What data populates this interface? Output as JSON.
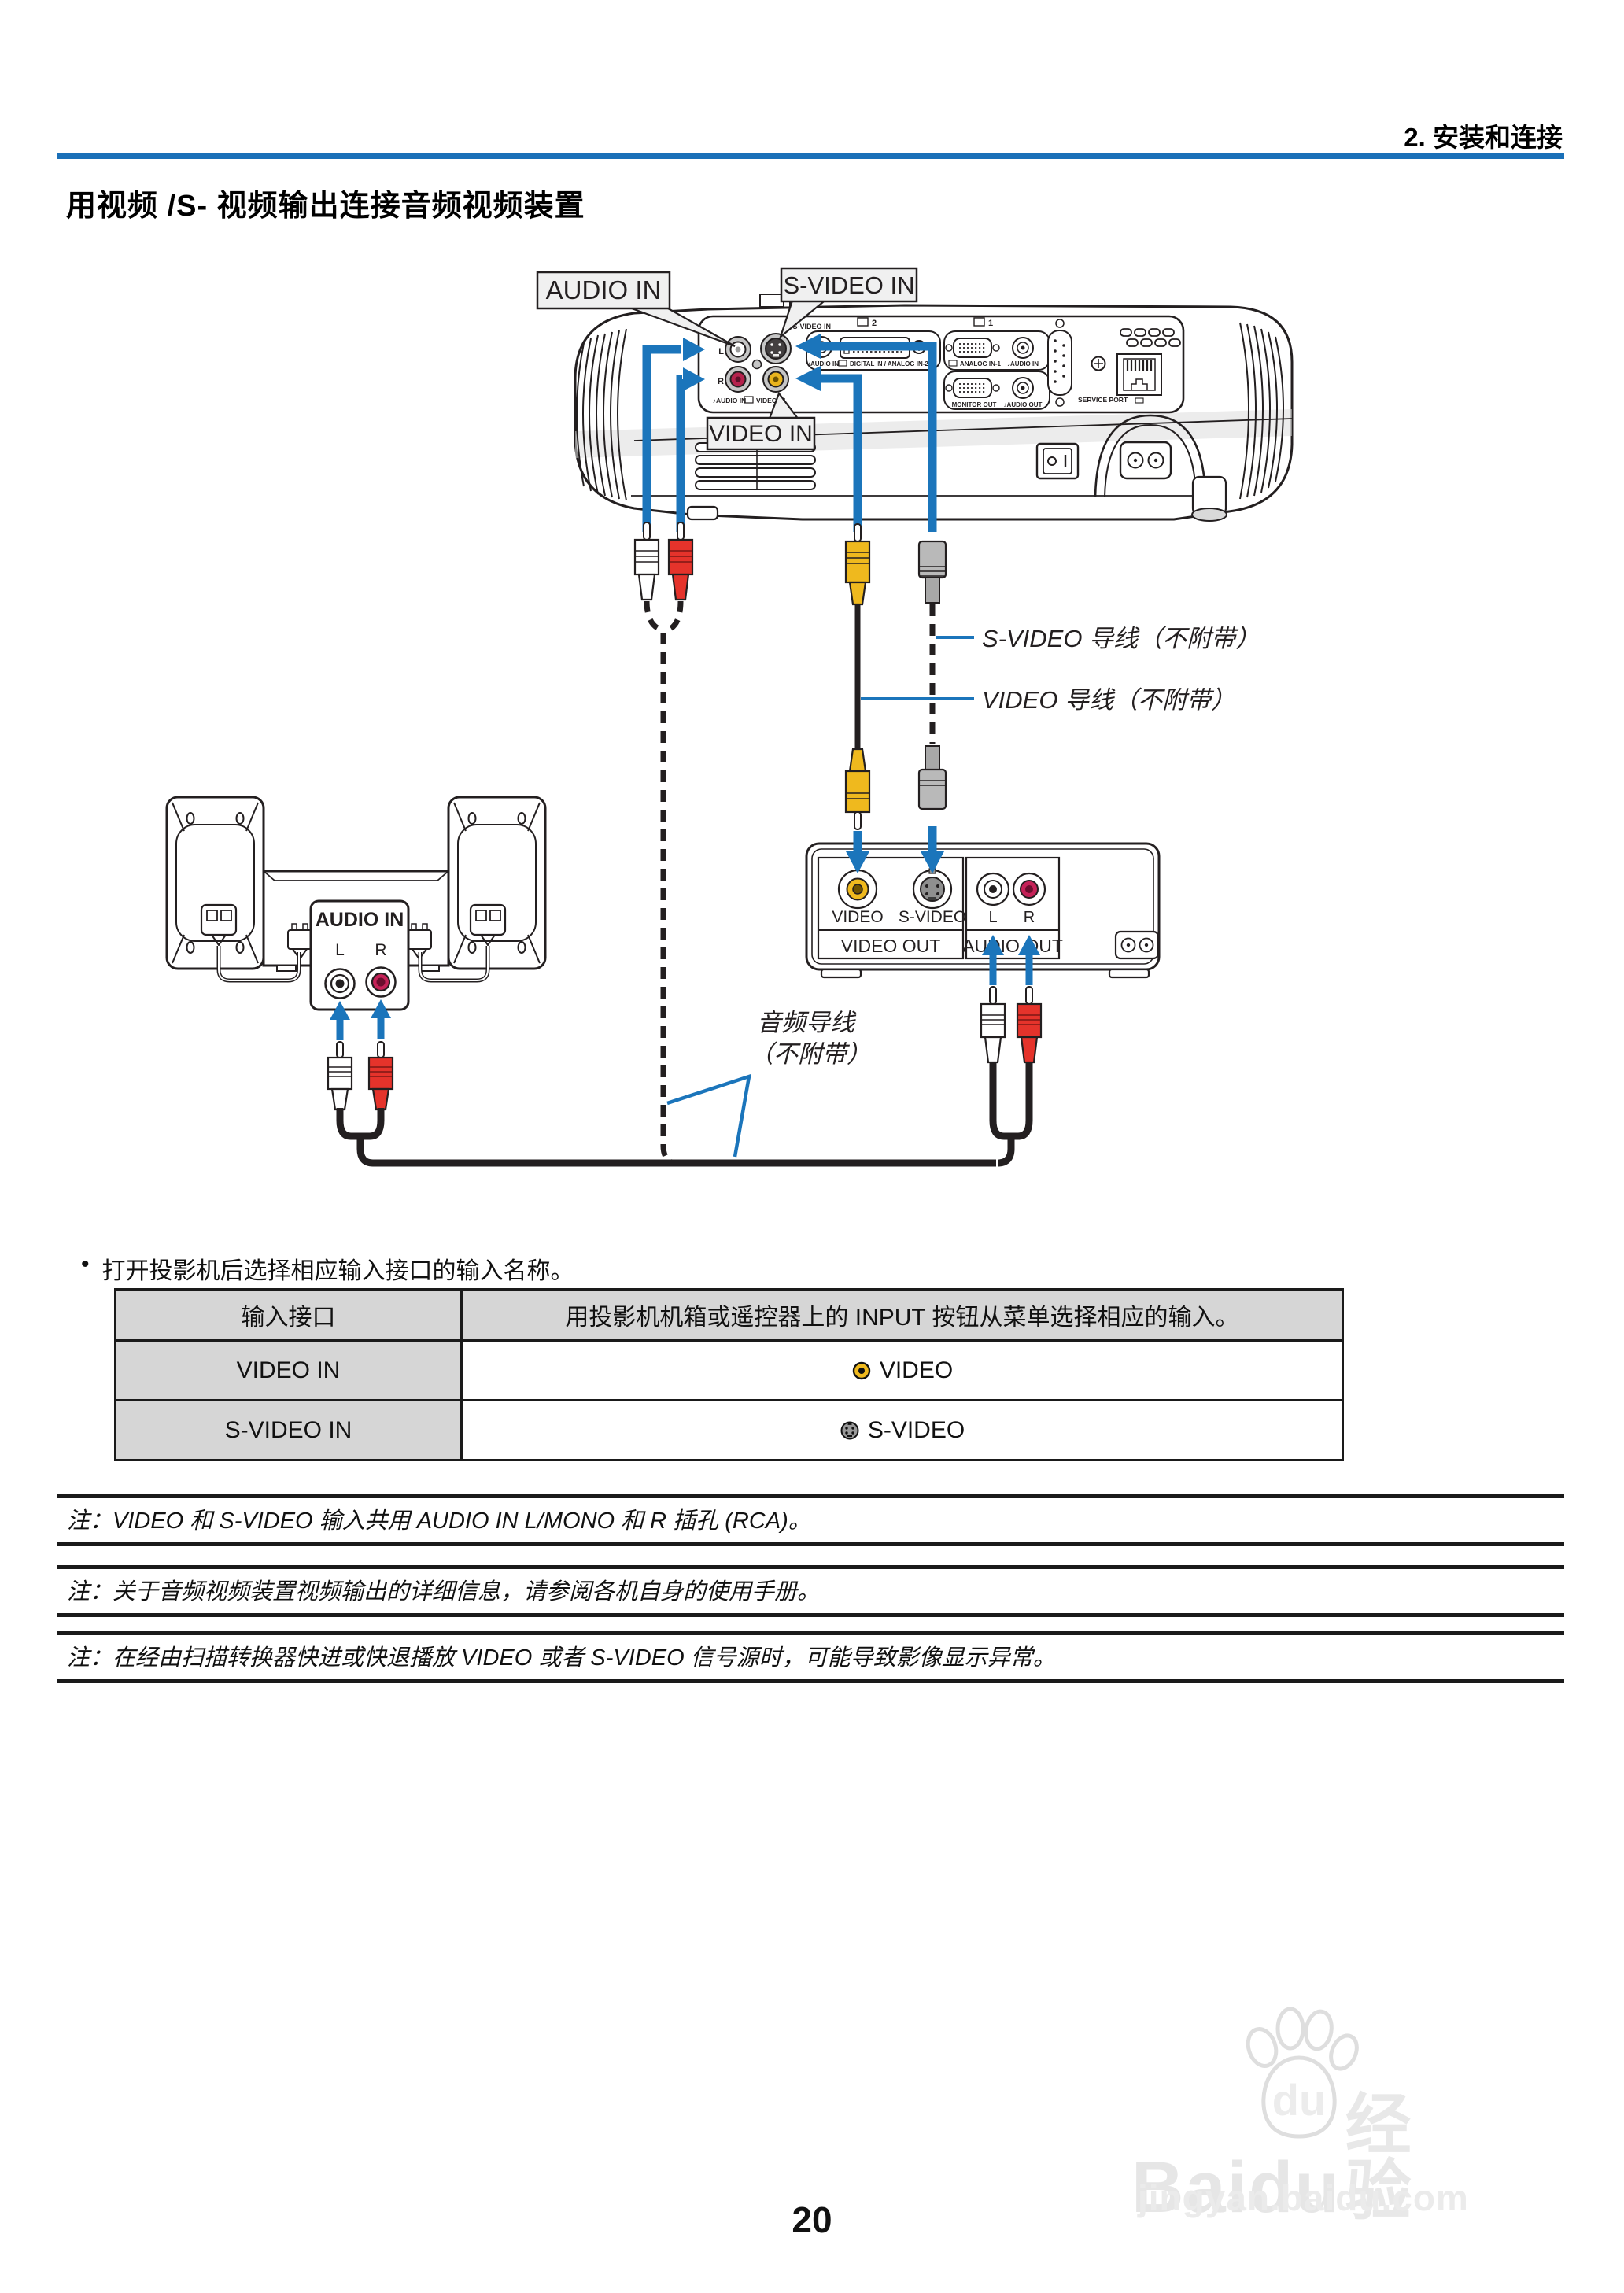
{
  "header": {
    "section": "2. 安装和连接"
  },
  "title": "用视频 /S- 视频输出连接音频视频装置",
  "diagram": {
    "callouts": {
      "audio_in": "AUDIO IN",
      "s_video_in": "S-VIDEO IN",
      "video_in": "VIDEO IN",
      "svideo_cable": "S-VIDEO 导线（不附带）",
      "video_cable": "VIDEO 导线（不附带）",
      "audio_cable_1": "音频导线",
      "audio_cable_2": "（不附带）"
    },
    "projector": {
      "l": "L",
      "r": "R",
      "svideo_port": "Ⓢ S-VIDEO IN",
      "audio_lr": "♪AUDIO IN",
      "video_port": "VIDEO IN",
      "audio_mid": "♪AUDIO IN",
      "digital_in": "DIGITAL IN / ANALOG IN-2",
      "display2": "2",
      "display1": "1",
      "analog_in1": "ANALOG IN-1",
      "audio_right": "♪AUDIO IN",
      "monitor_out": "MONITOR OUT",
      "audio_out": "♪AUDIO OUT",
      "service_port": "SERVICE PORT"
    },
    "amp": {
      "audio_in": "AUDIO IN",
      "l": "L",
      "r": "R"
    },
    "av_device": {
      "video": "VIDEO",
      "s_video": "S-VIDEO",
      "l": "L",
      "r": "R",
      "video_out": "VIDEO OUT",
      "audio_out": "AUDIO OUT"
    }
  },
  "bullet": {
    "marker": "•",
    "text": "打开投影机后选择相应输入接口的输入名称。"
  },
  "table": {
    "col1_header": "输入接口",
    "col2_header": "用投影机机箱或遥控器上的 INPUT 按钮从菜单选择相应的输入。",
    "rows": [
      {
        "port": "VIDEO IN",
        "input": "VIDEO"
      },
      {
        "port": "S-VIDEO IN",
        "input": "S-VIDEO"
      }
    ]
  },
  "notes": [
    "注：VIDEO 和 S-VIDEO 输入共用 AUDIO IN L/MONO 和 R 插孔 (RCA)。",
    "注：关于音频视频装置视频输出的详细信息，请参阅各机自身的使用手册。",
    "注：在经由扫描转换器快进或快退播放 VIDEO 或者 S-VIDEO 信号源时，可能导致影像显示异常。"
  ],
  "page_number": "20",
  "watermark": {
    "brand": "Baidu",
    "brand_suffix": "经验",
    "url": "jingyan.baidu.com"
  },
  "colors": {
    "accent_blue": "#1b75bb",
    "rule_blue": "#1a70b8",
    "line_art": "#231f20",
    "rca_yellow": "#efb91e",
    "rca_red": "#e5332b",
    "jack_magenta": "#c52258",
    "table_gray": "#d6d6d6"
  }
}
